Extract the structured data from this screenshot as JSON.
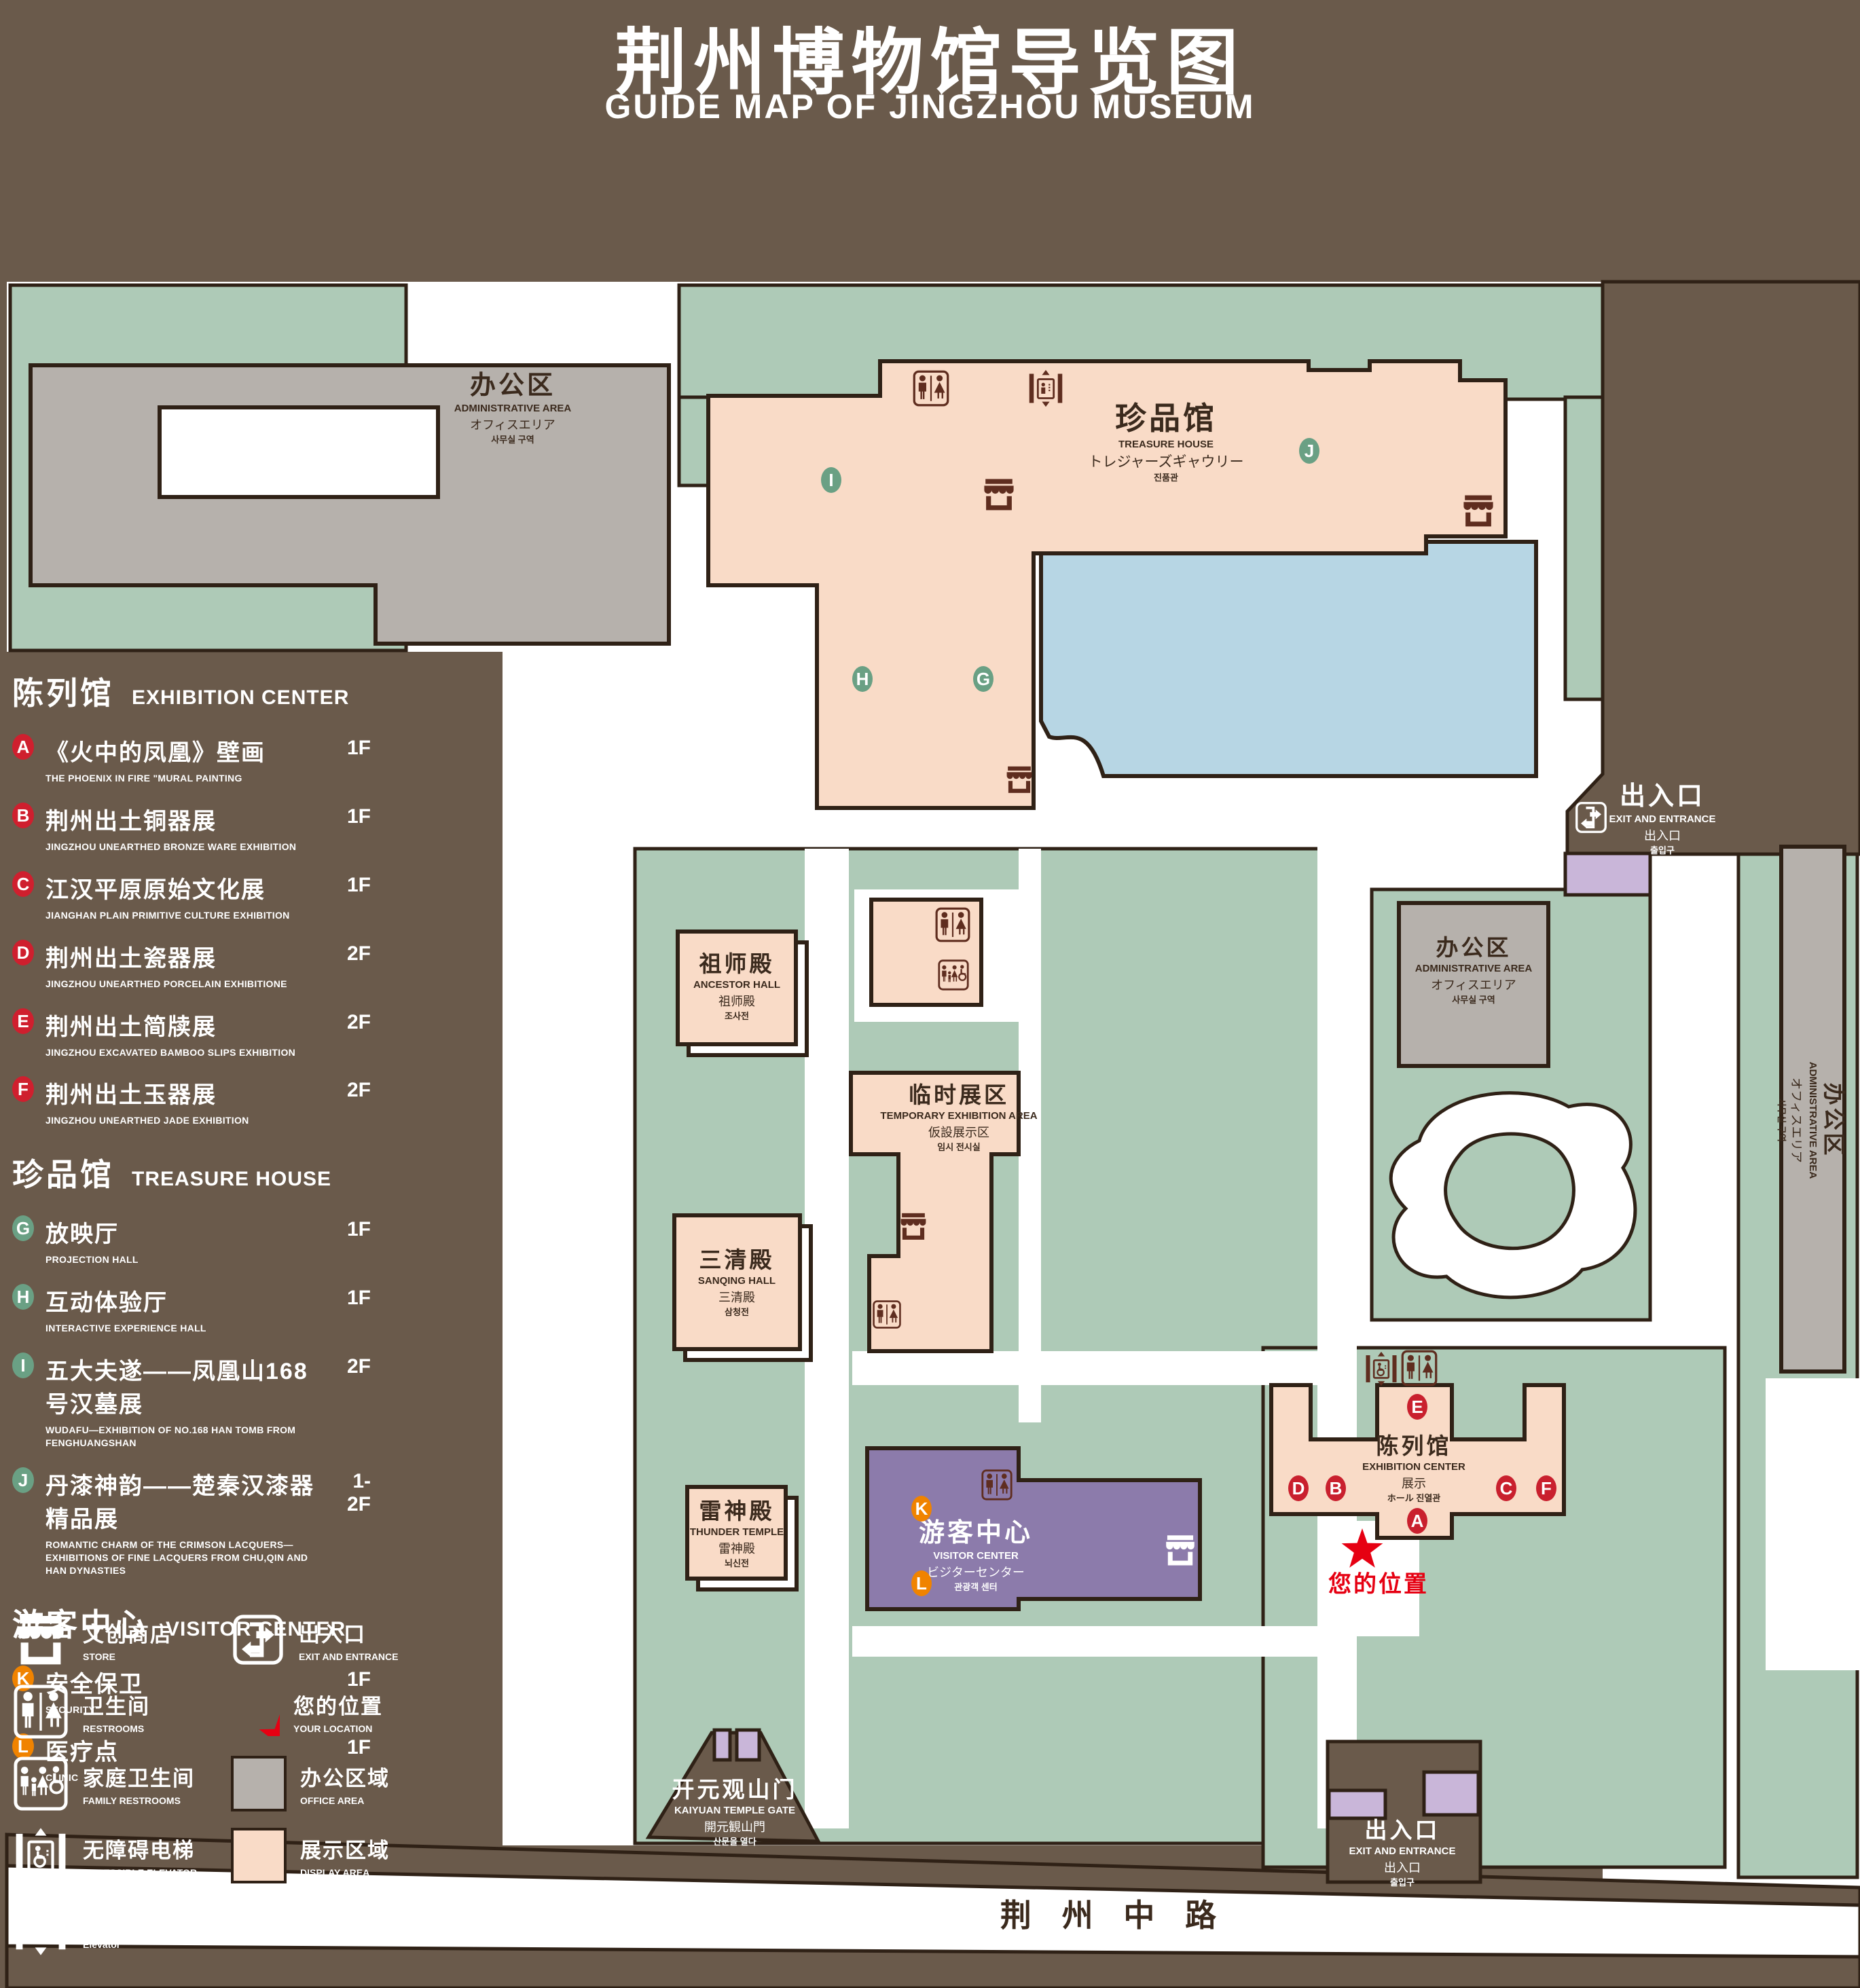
{
  "title": {
    "zh": "荆州博物馆导览图",
    "en": "GUIDE MAP OF JINGZHOU MUSEUM"
  },
  "colors": {
    "background": "#6a5a4b",
    "lawn": "#aecab7",
    "display_area": "#f9dbc7",
    "office_area": "#b6b1ac",
    "pond": "#b7d6e4",
    "visitor_center": "#8c7bab",
    "pad_purple": "#c9b6d9",
    "outline": "#2f2116",
    "marker_red": "#c9202e",
    "marker_green": "#6aa084",
    "marker_orange": "#f08300",
    "icon_dark": "#5f2d1f",
    "location_red": "#e60012",
    "white": "#ffffff"
  },
  "legend": {
    "sections": [
      {
        "zh": "陈列馆",
        "en": "EXHIBITION CENTER",
        "items": [
          {
            "id": "A",
            "zh": "《火中的凤凰》壁画",
            "en": "THE PHOENIX IN FIRE \"MURAL PAINTING",
            "floor": "1F"
          },
          {
            "id": "B",
            "zh": "荆州出土铜器展",
            "en": "JINGZHOU UNEARTHED BRONZE WARE EXHIBITION",
            "floor": "1F"
          },
          {
            "id": "C",
            "zh": "江汉平原原始文化展",
            "en": "JIANGHAN PLAIN PRIMITIVE CULTURE EXHIBITION",
            "floor": "1F"
          },
          {
            "id": "D",
            "zh": "荆州出土瓷器展",
            "en": "JINGZHOU UNEARTHED PORCELAIN EXHIBITIONE",
            "floor": "2F"
          },
          {
            "id": "E",
            "zh": "荆州出土简牍展",
            "en": "JINGZHOU EXCAVATED BAMBOO SLIPS EXHIBITION",
            "floor": "2F"
          },
          {
            "id": "F",
            "zh": "荆州出土玉器展",
            "en": "JINGZHOU UNEARTHED JADE EXHIBITION",
            "floor": "2F"
          }
        ]
      },
      {
        "zh": "珍品馆",
        "en": "TREASURE HOUSE",
        "items": [
          {
            "id": "G",
            "zh": "放映厅",
            "en": "PROJECTION HALL",
            "floor": "1F"
          },
          {
            "id": "H",
            "zh": "互动体验厅",
            "en": "INTERACTIVE EXPERIENCE HALL",
            "floor": "1F"
          },
          {
            "id": "I",
            "zh": "五大夫遂——凤凰山168号汉墓展",
            "en": "WUDAFU—EXHIBITION OF NO.168 HAN TOMB FROM FENGHUANGSHAN",
            "floor": "2F"
          },
          {
            "id": "J",
            "zh": "丹漆神韵——楚秦汉漆器精品展",
            "en": "ROMANTIC CHARM OF THE CRIMSON LACQUERS—EXHIBITIONS OF FINE LACQUERS FROM CHU,QIN AND HAN DYNASTIES",
            "floor": "1-2F"
          }
        ]
      },
      {
        "zh": "游客中心",
        "en": "VISITOR CENTER",
        "items": [
          {
            "id": "K",
            "zh": "安全保卫",
            "en": "SECURITY",
            "floor": "1F"
          },
          {
            "id": "L",
            "zh": "医疗点",
            "en": "CLINIC",
            "floor": "1F"
          }
        ]
      }
    ],
    "symbols": [
      {
        "zh": "文创商店",
        "en": "STORE"
      },
      {
        "zh": "出入口",
        "en": "EXIT AND ENTRANCE"
      },
      {
        "zh": "卫生间",
        "en": "RESTROOMS"
      },
      {
        "zh": "您的位置",
        "en": "YOUR LOCATION"
      },
      {
        "zh": "家庭卫生间",
        "en": "FAMILY RESTROOMS"
      },
      {
        "zh": "办公区域",
        "en": "OFFICE AREA"
      },
      {
        "zh": "无障碍电梯",
        "en": "ACCESSIBLE ELEVATOR"
      },
      {
        "zh": "展示区域",
        "en": "DISPLAY AREA"
      },
      {
        "zh": "电梯",
        "en": "Elevator"
      }
    ]
  },
  "map": {
    "admin": {
      "zh": "办公区",
      "en": "ADMINISTRATIVE AREA",
      "ja": "オフィスエリア",
      "ko": "사무실 구역"
    },
    "treasure": {
      "zh": "珍品馆",
      "en": "TREASURE HOUSE",
      "ja": "トレジャーズギャウリー",
      "ko": "진품관"
    },
    "ancestor": {
      "zh": "祖师殿",
      "en": "ANCESTOR HALL",
      "ja": "祖师殿",
      "ko": "조사전"
    },
    "temp": {
      "zh": "临时展区",
      "en": "TEMPORARY EXHIBITION AREA",
      "ja": "仮設展示区",
      "ko": "임시 전시실"
    },
    "sanqing": {
      "zh": "三清殿",
      "en": "SANQING HALL",
      "ja": "三清殿",
      "ko": "삼청전"
    },
    "thunder": {
      "zh": "雷神殿",
      "en": "THUNDER TEMPLE",
      "ja": "雷神殿",
      "ko": "뇌신전"
    },
    "visitor": {
      "zh": "游客中心",
      "en": "VISITOR CENTER",
      "ja": "ビジターセンター",
      "ko": "관광객 센터"
    },
    "exhibition": {
      "zh": "陈列馆",
      "en": "EXHIBITION CENTER",
      "ja": "展示",
      "ko": "ホール 진열관"
    },
    "gate": {
      "zh": "开元观山门",
      "en": "KAIYUAN TEMPLE GATE",
      "ja": "開元観山門",
      "ko": "산문을 열다"
    },
    "exit": {
      "zh": "出入口",
      "en": "EXIT AND ENTRANCE",
      "ja": "出入口",
      "ko": "출입구"
    },
    "road": "荆 州 中 路",
    "your_location": "您的位置",
    "markers": [
      {
        "id": "A"
      },
      {
        "id": "B"
      },
      {
        "id": "C"
      },
      {
        "id": "D"
      },
      {
        "id": "E"
      },
      {
        "id": "F"
      },
      {
        "id": "G"
      },
      {
        "id": "H"
      },
      {
        "id": "I"
      },
      {
        "id": "J"
      },
      {
        "id": "K"
      },
      {
        "id": "L"
      }
    ]
  }
}
